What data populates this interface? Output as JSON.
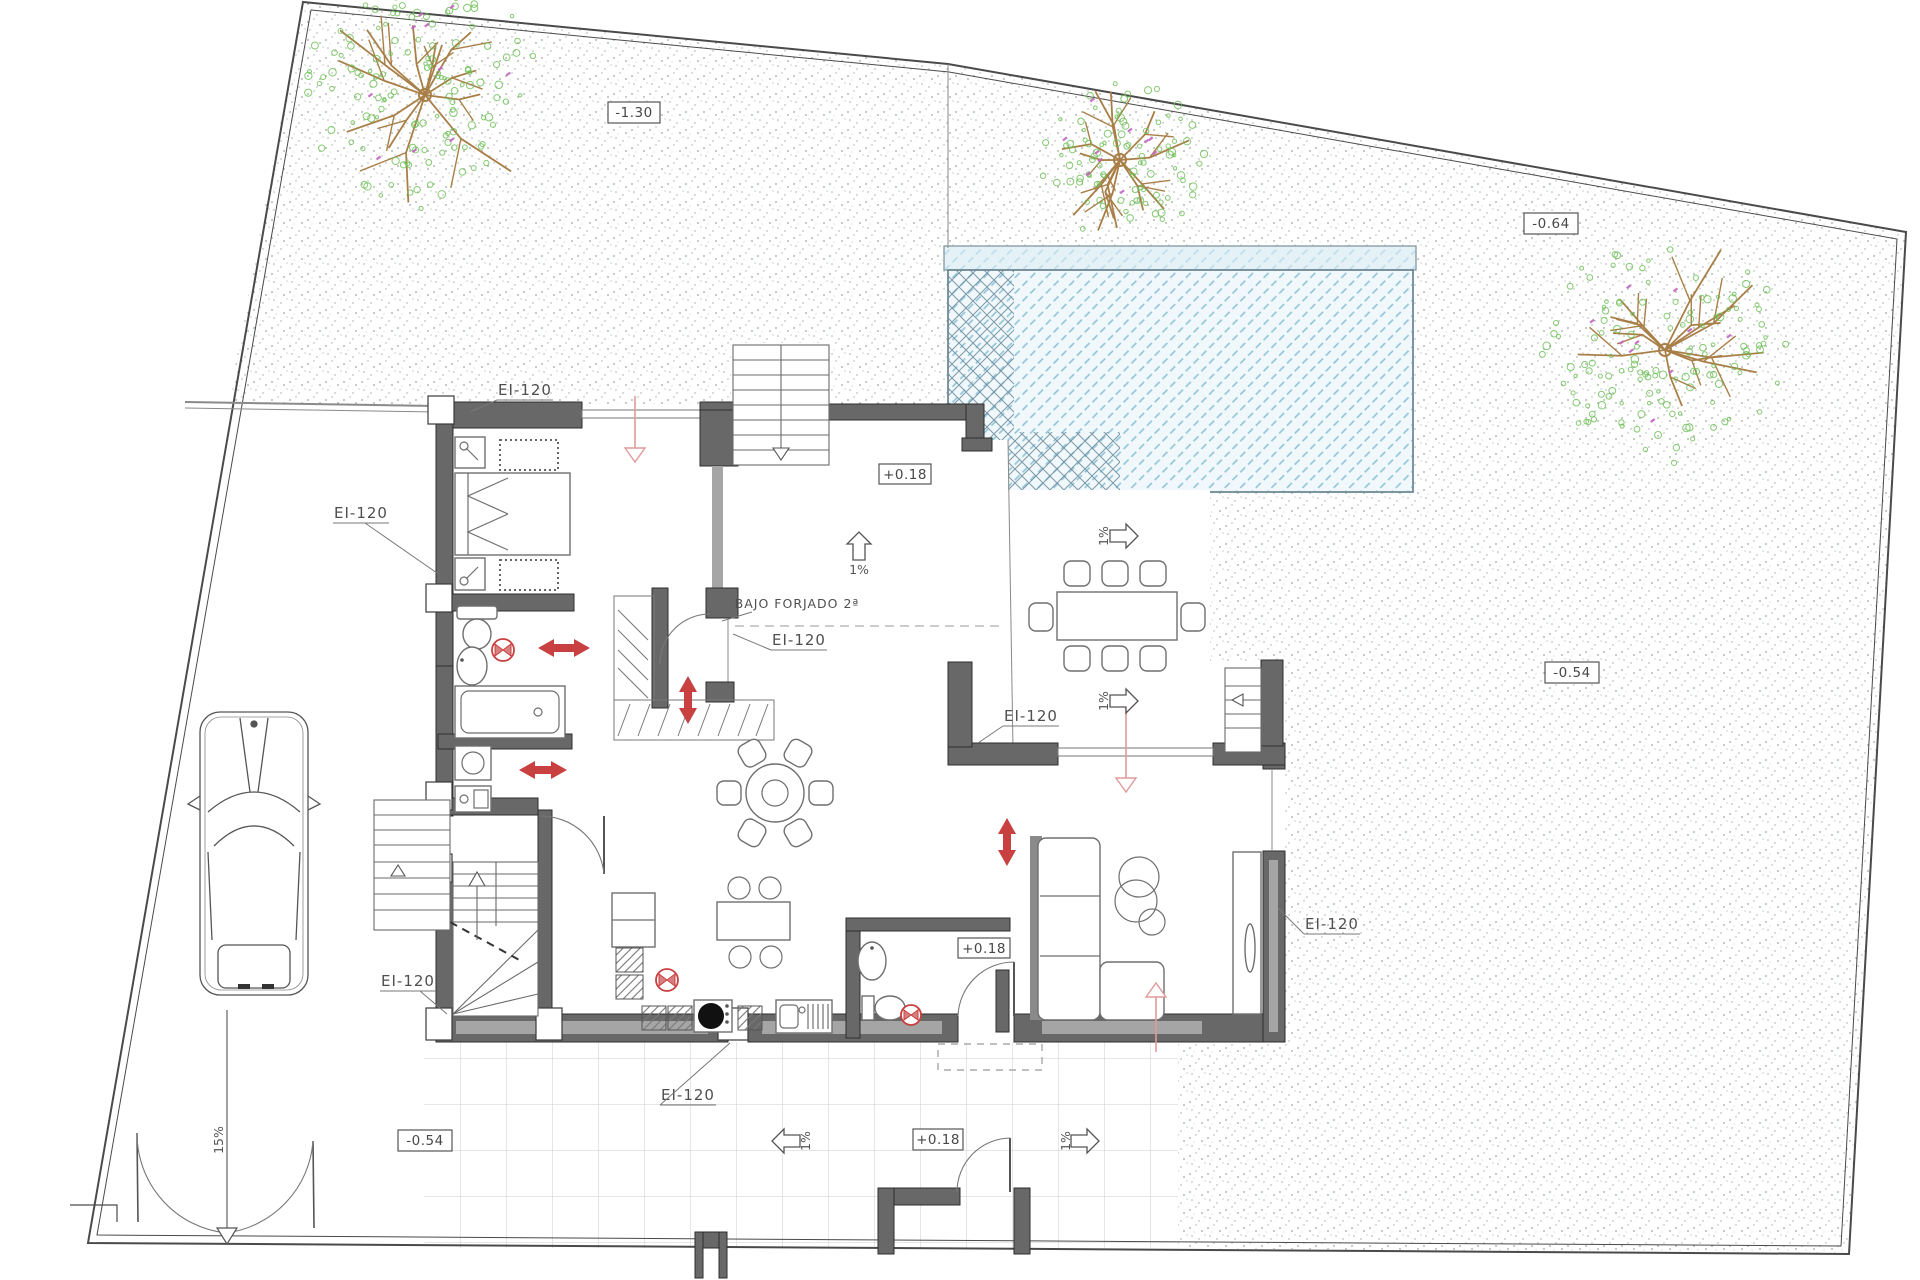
{
  "labels": {
    "fire_rating": "EI-120",
    "note_bajo_forjado": "BAJO FORJADO 2ª"
  },
  "levels": {
    "garden_northwest": "-1.30",
    "garden_northeast": "-0.64",
    "garden_east": "-0.54",
    "driveway": "-0.54",
    "deck_north": "+0.18",
    "wc_terrace": "+0.18",
    "porch_south": "+0.18"
  },
  "slopes": {
    "deck": "1%",
    "dining_north": "1%",
    "dining_south": "1%",
    "patio_west": "1%",
    "patio_east": "1%",
    "driveway": "15%"
  },
  "colors": {
    "accent_red": "#c84040",
    "window_pink": "#df9a9a",
    "pool_water": "#f0f8fb",
    "pool_hatch": "#8fc3d8",
    "wall_dark": "#686868",
    "wall_light": "#a5a5a5",
    "stipple": "#9aa89a",
    "tree_branch": "#a97f48",
    "tree_foliage": "#6fbf58",
    "tree_blossom": "#c263c2",
    "grid_line": "#cdcdcd"
  }
}
